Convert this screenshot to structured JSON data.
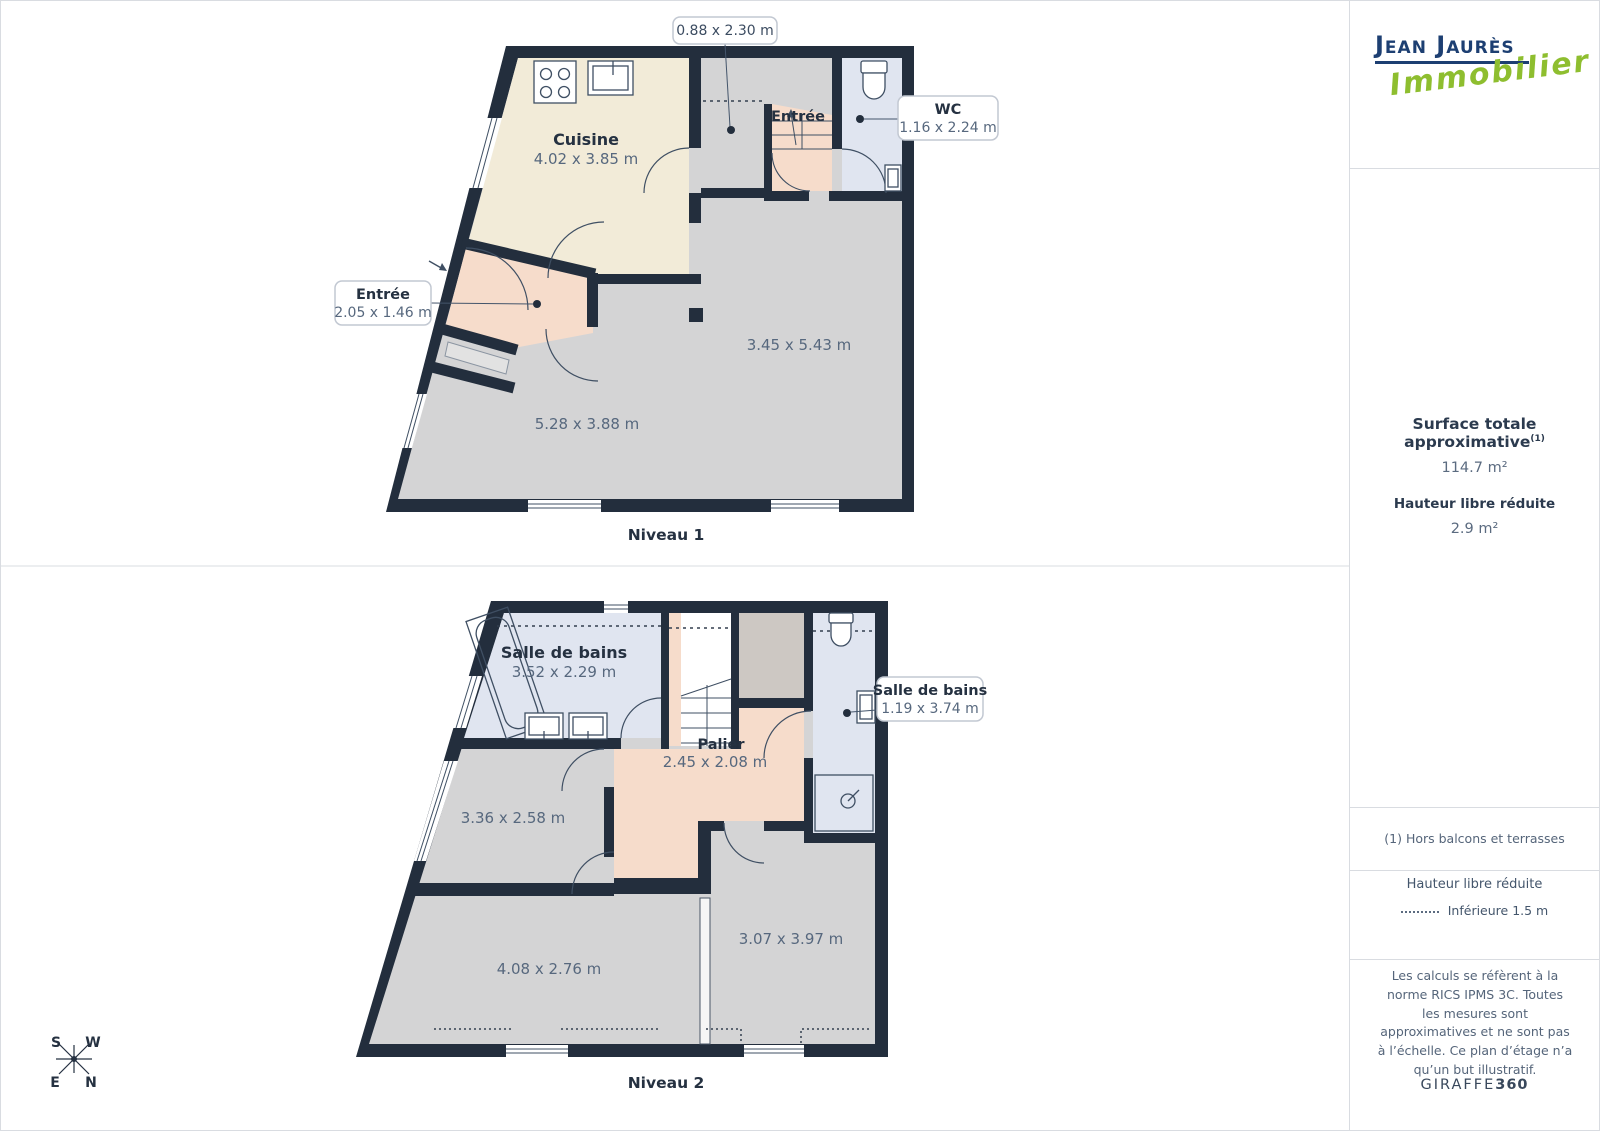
{
  "logo": {
    "line1": "Jean Jaurès",
    "line2": "Immobilier"
  },
  "sidebar": {
    "surface_title": "Surface totale approximative",
    "surface_sup": "(1)",
    "surface_value": "114.7 m²",
    "reduced_height_title": "Hauteur libre réduite",
    "reduced_height_value": "2.9 m²",
    "footnote": "(1) Hors balcons et terrasses",
    "legend_title": "Hauteur libre réduite",
    "legend_item": "Inférieure 1.5 m",
    "disclaimer": "Les calculs se réfèrent à la norme RICS IPMS 3C. Toutes les mesures sont approximatives et ne sont pas à l’échelle. Ce plan d’étage n’a qu’un but illustratif.",
    "brand_name": "GIRAFFE",
    "brand_number": "360"
  },
  "level1": {
    "title": "Niveau 1",
    "cuisine": {
      "name": "Cuisine",
      "dims": "4.02 x 3.85 m"
    },
    "entree_room": {
      "name": "Entrée"
    },
    "living_dim_right": "3.45 x 5.43 m",
    "living_dim_left": "5.28 x 3.88 m",
    "callout_corridor": {
      "dims": "0.88 x 2.30 m"
    },
    "callout_wc": {
      "name": "WC",
      "dims": "1.16 x 2.24 m"
    },
    "callout_entree": {
      "name": "Entrée",
      "dims": "2.05 x 1.46 m"
    }
  },
  "level2": {
    "title": "Niveau 2",
    "bathroom_main": {
      "name": "Salle de bains",
      "dims": "3.52 x 2.29 m"
    },
    "palier": {
      "name": "Palier",
      "dims": "2.45 x 2.08 m"
    },
    "callout_bathroom": {
      "name": "Salle de bains",
      "dims": "1.19 x 3.74 m"
    },
    "bedroom_top_dim": "3.36 x 2.58 m",
    "bedroom_left_dim": "4.08 x 2.76 m",
    "bedroom_right_dim": "3.07 x 3.97 m"
  },
  "compass": {
    "s": "S",
    "w": "W",
    "e": "E",
    "n": "N"
  },
  "colors": {
    "wall": "#232e3d",
    "floor": "#d4d4d5",
    "kitchen": "#f2ebd8",
    "hall": "#f6dccb",
    "bath": "#e0e5f0",
    "store": "#cdc8c3",
    "logo_blue": "#1d3f72",
    "logo_green": "#8ebe2f"
  }
}
